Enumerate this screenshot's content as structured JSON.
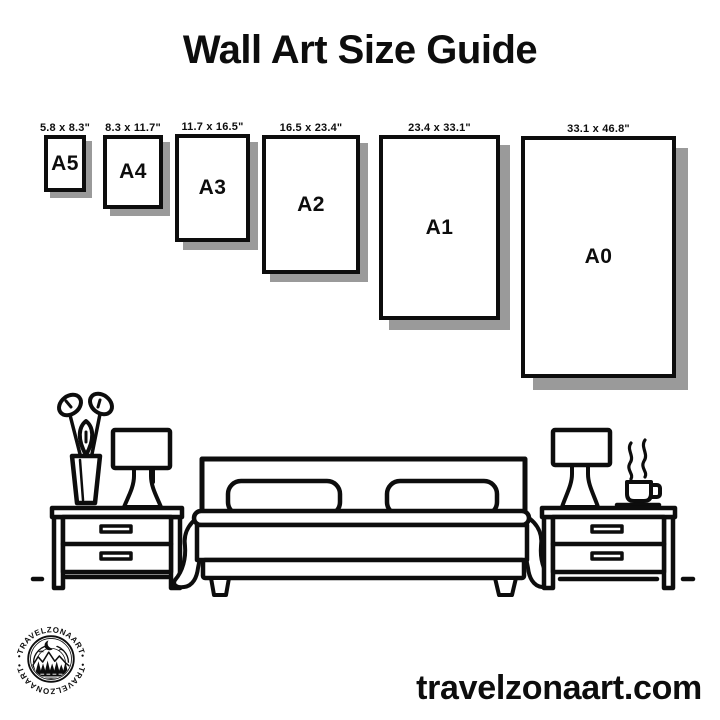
{
  "title": "Wall Art Size Guide",
  "size_guide": {
    "sizes": [
      {
        "code": "A5",
        "dims": "5.8 x 8.3\""
      },
      {
        "code": "A4",
        "dims": "8.3 x 11.7\""
      },
      {
        "code": "A3",
        "dims": "11.7 x 16.5\""
      },
      {
        "code": "A2",
        "dims": "16.5 x 23.4\""
      },
      {
        "code": "A1",
        "dims": "23.4 x 33.1\""
      },
      {
        "code": "A0",
        "dims": "33.1 x 46.8\""
      }
    ]
  },
  "logo": {
    "arc_text": "•TRAVELZONAART•"
  },
  "footer": {
    "website": "travelzonaart.com"
  },
  "colors": {
    "ink": "#0d0d0d",
    "shadow": "#9a9a9a",
    "background": "#ffffff"
  }
}
